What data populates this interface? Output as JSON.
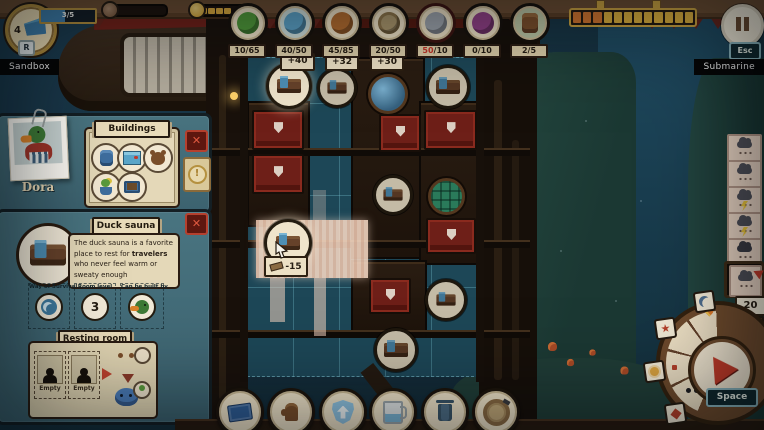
{
  "hud": {
    "flag": {
      "count": "4",
      "key": "R"
    },
    "quest_bar": "3/5",
    "coin_pips": 4,
    "timeline": {
      "segments_total": 12,
      "segments_elapsed": 3
    },
    "pause_key": "Esc",
    "resources": [
      {
        "icon": "cabbage",
        "value": "10",
        "cap": "/65",
        "over": false
      },
      {
        "icon": "fish",
        "value": "40",
        "cap": "/50",
        "over": false
      },
      {
        "icon": "bark",
        "value": "45",
        "cap": "/85",
        "over": false
      },
      {
        "icon": "planks",
        "value": "20",
        "cap": "/50",
        "over": false
      },
      {
        "icon": "metal",
        "value": "50",
        "cap": "/10",
        "over": true
      },
      {
        "icon": "dye",
        "value": "0",
        "cap": "/10",
        "over": false
      },
      {
        "icon": "barrel",
        "value": "2",
        "cap": "/5",
        "over": false
      }
    ]
  },
  "zones": {
    "left": "Sandbox",
    "right": "Submarine"
  },
  "character": {
    "name": "Dora"
  },
  "buildings": {
    "title": "Buildings",
    "alert": "!"
  },
  "tooltip": {
    "title": "Duck sauna",
    "desc_pre": "The duck sauna is a favorite place to rest for ",
    "desc_bold": "travelers",
    "desc_post": " who never feel warm or sweaty enough",
    "way_label": "Way of Survival",
    "level_label": "Room level",
    "level_value": "3",
    "builder_label": "Can be built by"
  },
  "resting_room": {
    "title": "Resting room",
    "slot1": "Empty",
    "slot2": "Empty"
  },
  "placement": {
    "bonus1": "+40",
    "bonus2": "+32",
    "bonus3": "+30",
    "cost": "-15"
  },
  "radial": {
    "counter": "20",
    "key": "Space"
  },
  "close_label": "✕"
}
